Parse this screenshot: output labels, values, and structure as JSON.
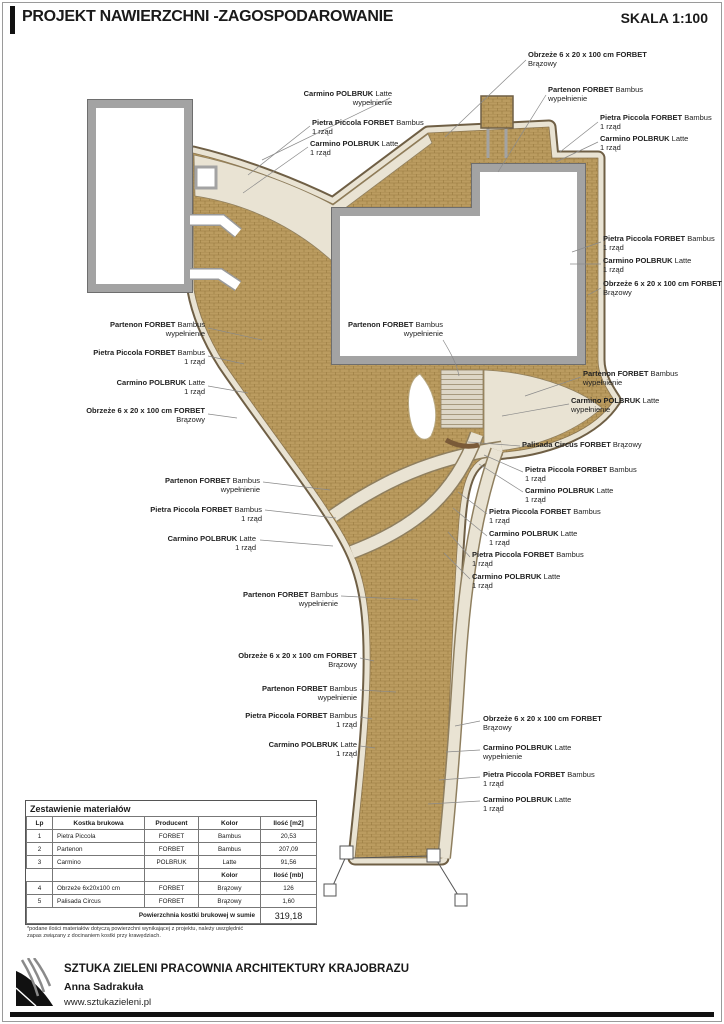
{
  "header": {
    "title": "PROJEKT NAWIERZCHNI -ZAGOSPODAROWANIE",
    "scale": "SKALA 1:100"
  },
  "labels": {
    "obrzeze": {
      "bold": "Obrzeże 6 x 20 x 100 cm FORBET",
      "normal": "",
      "line2": "Brązowy"
    },
    "partenon_wyp": {
      "bold": "Partenon FORBET",
      "normal": " Bambus",
      "line2": "wypełnienie"
    },
    "pietra_rzad": {
      "bold": "Pietra Piccola FORBET",
      "normal": " Bambus",
      "line2": "1 rząd"
    },
    "carmino_rzad": {
      "bold": "Carmino POLBRUK",
      "normal": " Latte",
      "line2": "1 rząd"
    },
    "carmino_wyp": {
      "bold": "Carmino POLBRUK",
      "normal": " Latte",
      "line2": "wypełnienie"
    },
    "palisada": {
      "bold": "Palisada Circus FORBET",
      "normal": " Brązowy",
      "line2": ""
    }
  },
  "table": {
    "title": "Zestawienie materiałów",
    "headers": [
      "Lp",
      "Kostka brukowa",
      "Producent",
      "Kolor",
      "Ilość [m2]"
    ],
    "rows": [
      [
        "1",
        "Pietra Piccola",
        "FORBET",
        "Bambus",
        "20,53"
      ],
      [
        "2",
        "Partenon",
        "FORBET",
        "Bambus",
        "207,09"
      ],
      [
        "3",
        "Carmino",
        "POLBRUK",
        "Latte",
        "91,56"
      ]
    ],
    "subheaders": {
      "kolor": "Kolor",
      "ilosc": "Ilość [mb]"
    },
    "rows2": [
      [
        "4",
        "Obrzeże  6x20x100 cm",
        "FORBET",
        "Brązowy",
        "126"
      ],
      [
        "5",
        "Palisada Circus",
        "FORBET",
        "Brązowy",
        "1,60"
      ]
    ],
    "total_label": "Powierzchnia kostki brukowej w sumie",
    "total_value": "319,18",
    "footnote": "*podane ilości materiałów dotyczą powierzchni wynikającej z projektu, należy uwzględnić\nzapas związany z docinaniem kostki przy krawędziach."
  },
  "footer": {
    "company": "SZTUKA ZIELENI PRACOWNIA ARCHITEKTURY KRAJOBRAZU",
    "name": "Anna Sadrakuła",
    "website": "www.sztukazieleni.pl"
  },
  "colors": {
    "paving": "#bb9c60",
    "paving_joint": "#97793f",
    "latte": "#e9e3d3",
    "edge_brown": "#6f5f45",
    "wall_gray": "#a3a3a3"
  }
}
